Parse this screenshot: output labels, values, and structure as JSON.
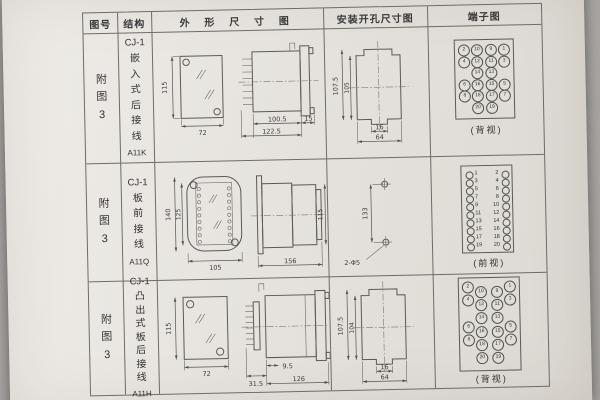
{
  "header": {
    "col_fig": "图号",
    "col_structure": "结构",
    "col_outline": "外 形 尺 寸 图",
    "col_install": "安装开孔尺寸图",
    "col_terminal": "端子图"
  },
  "rows": [
    {
      "fig_label": "附图3",
      "structure": {
        "model": "CJ-1",
        "name": "嵌入式后接线",
        "code": "A11K"
      },
      "outline": {
        "front_h": "115",
        "front_w": "72",
        "side_d1": "100.5",
        "side_d2": "122.5",
        "side_d3": "15"
      },
      "install": {
        "outer_h": "107.5",
        "inner_h": "105",
        "inner_w": "16",
        "outer_w": "64"
      },
      "terminal": {
        "view_label": "(背视)",
        "grid": [
          [
            2,
            10,
            9,
            1
          ],
          [
            4,
            12,
            11,
            3
          ],
          [
            null,
            14,
            13,
            null
          ],
          [
            6,
            16,
            15,
            5
          ],
          [
            8,
            18,
            17,
            7
          ],
          [
            null,
            20,
            19,
            null
          ]
        ]
      }
    },
    {
      "fig_label": "附图3",
      "structure": {
        "model": "CJ-1",
        "name": "板前接线",
        "code": "A11Q"
      },
      "outline": {
        "front_h_outer": "140",
        "front_h_inner": "125",
        "front_w": "105",
        "side_w": "156",
        "side_h": "115"
      },
      "install": {
        "hole_spacing": "133",
        "hole_label": "2-Φ5"
      },
      "terminal": {
        "view_label": "(前视)",
        "left": [
          1,
          3,
          5,
          7,
          9,
          11,
          13,
          15,
          17,
          19
        ],
        "right": [
          2,
          4,
          6,
          8,
          10,
          12,
          14,
          16,
          18,
          20
        ]
      }
    },
    {
      "fig_label": "附图3",
      "structure": {
        "model": "CJ-1",
        "name": "凸出式板后接线",
        "code": "A11H"
      },
      "outline": {
        "front_h": "115",
        "front_w": "72",
        "side_d1": "31.5",
        "side_d2": "9.5",
        "side_d3": "126"
      },
      "install": {
        "outer_h": "107.5",
        "inner_h": "104",
        "inner_w": "16",
        "outer_w": "64"
      },
      "terminal": {
        "view_label": "(背视)",
        "grid": [
          [
            2,
            10,
            9,
            1
          ],
          [
            4,
            12,
            11,
            3
          ],
          [
            null,
            14,
            13,
            null
          ],
          [
            6,
            16,
            15,
            5
          ],
          [
            8,
            18,
            17,
            7
          ],
          [
            null,
            20,
            19,
            null
          ]
        ]
      }
    }
  ]
}
